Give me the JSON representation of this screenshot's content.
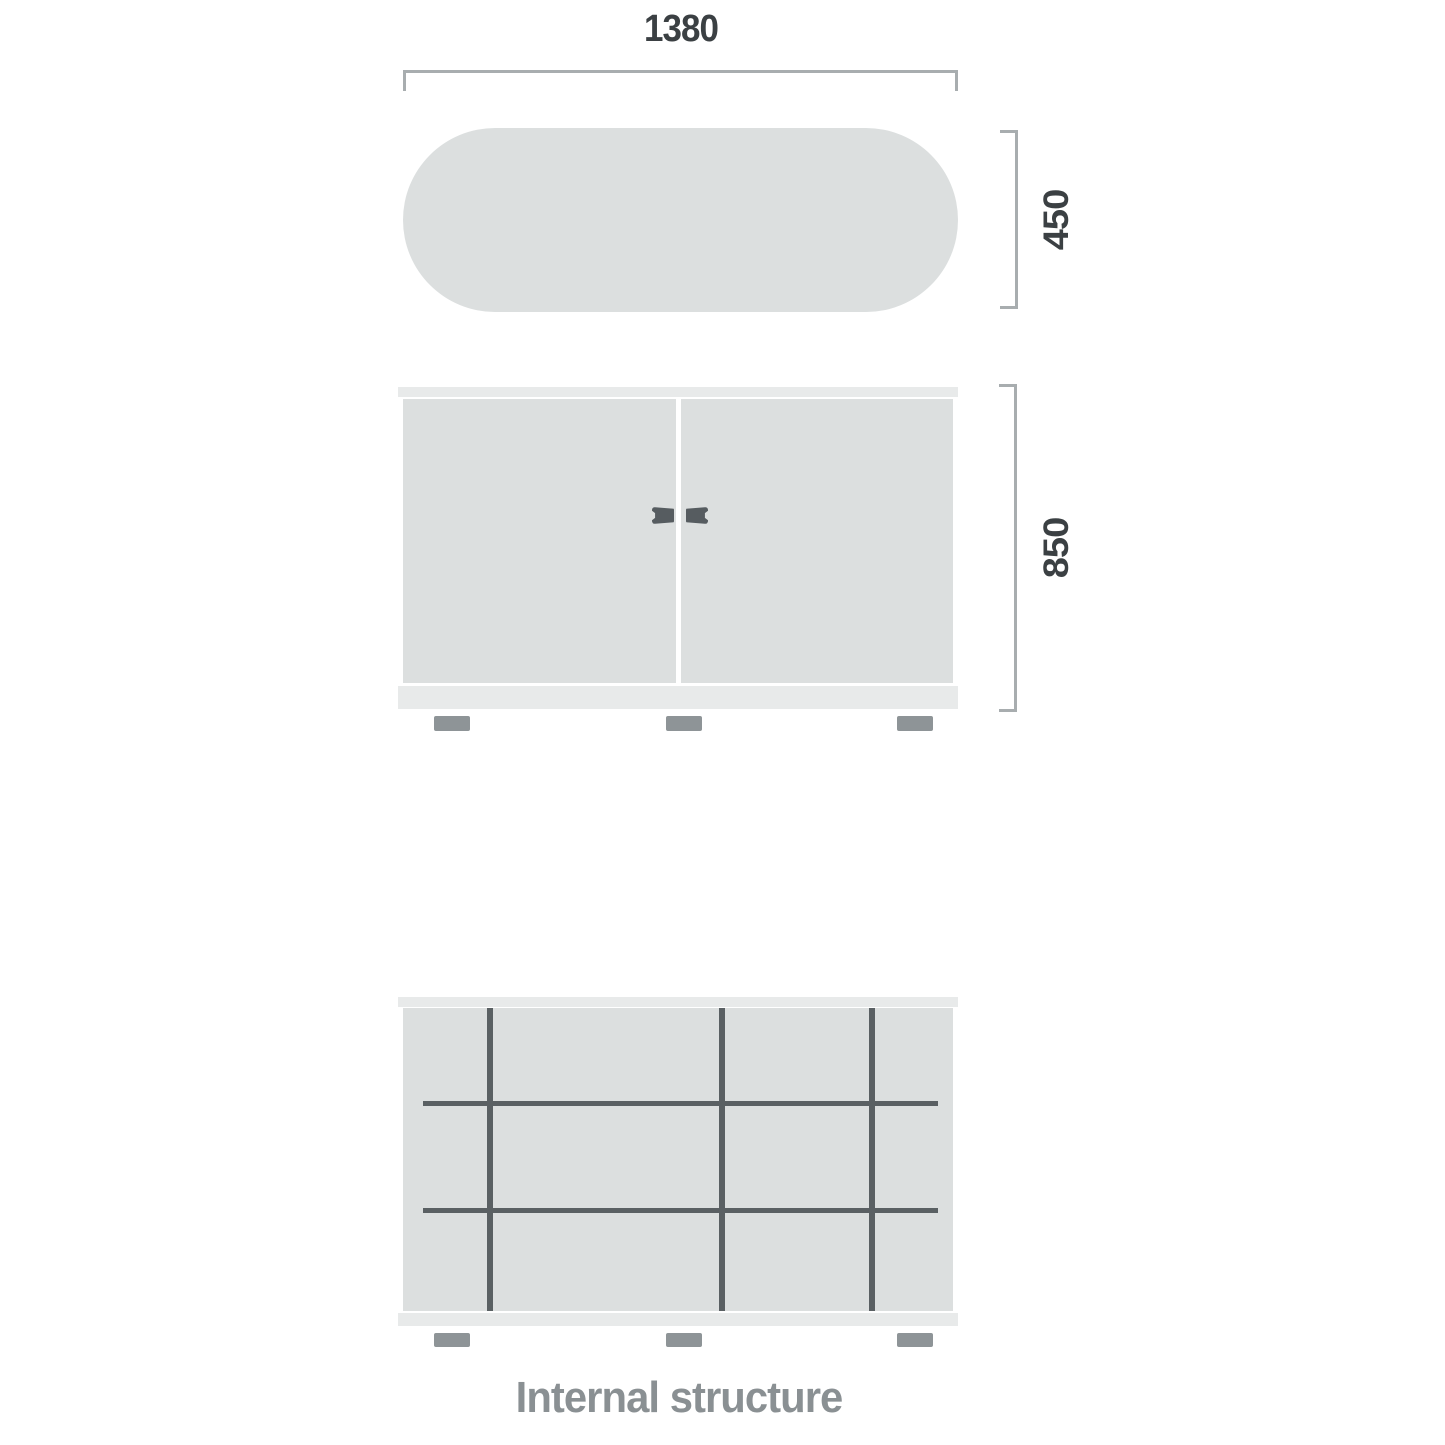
{
  "drawing": {
    "width_dimension": "1380",
    "depth_dimension": "450",
    "height_dimension": "850",
    "caption": "Internal structure"
  },
  "colors": {
    "panel-fill": "#dcdfdf",
    "strip-fill": "#e8eaea",
    "line-dark": "#5a6063",
    "handle-fill": "#565c60",
    "feet-fill": "#8e9497",
    "dim-line": "#a8adaf",
    "dim-text": "#3b4043",
    "caption-text": "#8a9093",
    "background": "#ffffff"
  }
}
